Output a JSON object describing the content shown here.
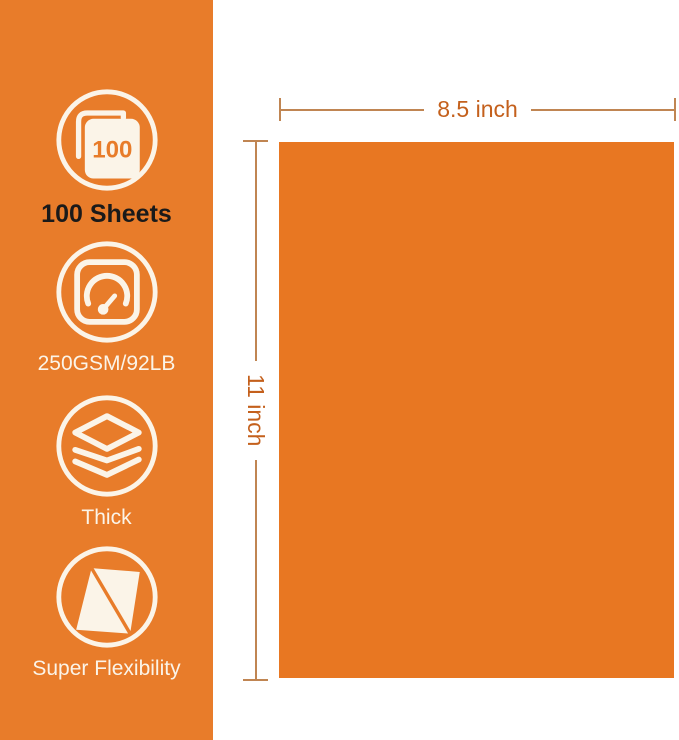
{
  "colors": {
    "bg": "#FFFFFF",
    "band_orange": "#E87C2A",
    "paper_orange": "#E87722",
    "icon_white": "#FBF4E8",
    "label_dark": "#1A1A1A",
    "dim_line": "#C08552",
    "dim_text": "#C4601C"
  },
  "sidebar": {
    "features": [
      {
        "icon": "sheets-count-icon",
        "badge": "100",
        "label": "100 Sheets"
      },
      {
        "icon": "gauge-icon",
        "label": "250GSM/92LB"
      },
      {
        "icon": "layers-icon",
        "label": "Thick"
      },
      {
        "icon": "flexible-sheet-icon",
        "label": "Super Flexibility"
      }
    ]
  },
  "diagram": {
    "width_label": "8.5 inch",
    "height_label": "11 inch"
  }
}
